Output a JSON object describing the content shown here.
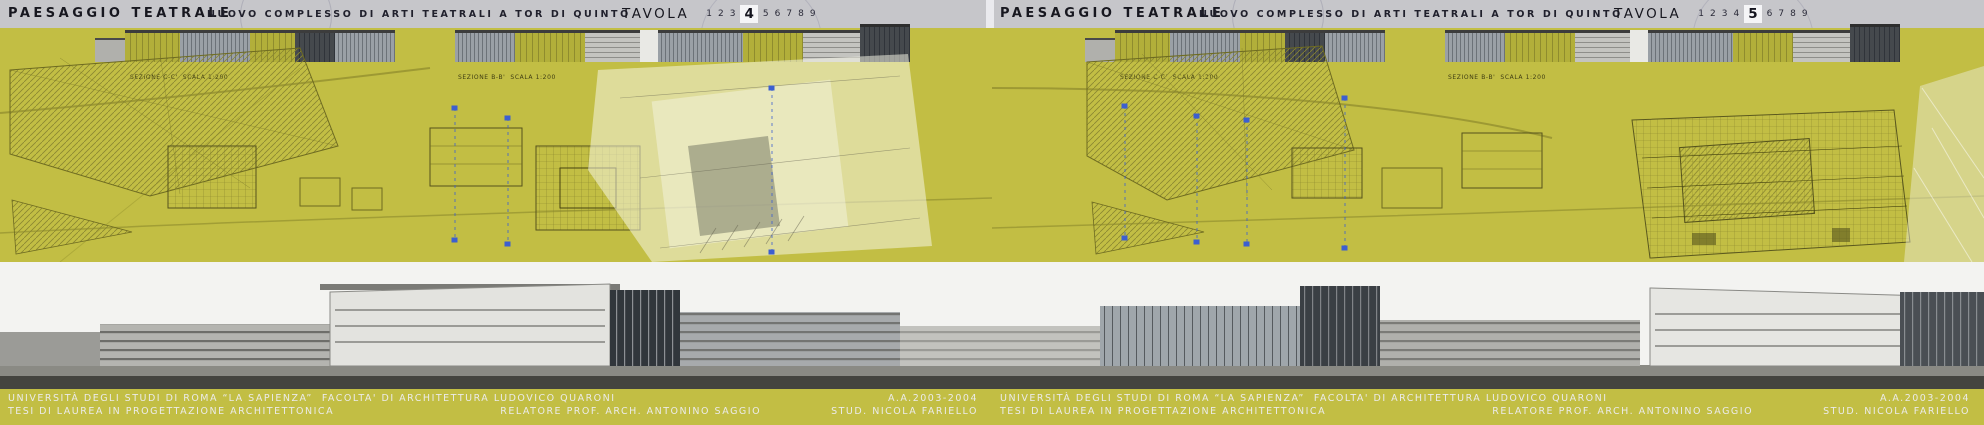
{
  "colors": {
    "olive_background": "#c2be44",
    "header_silver": "#c6c6ca",
    "header_text": "#17171f",
    "plan_linework": "#6e6b21",
    "section_marker_blue": "#3c5fd0",
    "footer_black": "#060606",
    "footer_text": "#ebebe9"
  },
  "panels": [
    {
      "header": {
        "title": "PAESAGGIO TEATRALE",
        "subtitle": "NUOVO COMPLESSO DI ARTI TEATRALI A TOR DI QUINTO",
        "tavola_label": "TAVOLA",
        "numbers": [
          "1",
          "2",
          "3",
          "4",
          "5",
          "6",
          "7",
          "8",
          "9"
        ],
        "active_number": "4"
      },
      "drawings": {
        "section_caption_1": "SEZIONE C-C'  SCALA 1:200",
        "section_caption_2": "SEZIONE B-B'  SCALA 1:200"
      },
      "footer": {
        "university_line": "UNIVERSITÀ DEGLI STUDI DI ROMA “LA SAPIENZA”  FACOLTA' DI ARCHITETTURA LUDOVICO QUARONI",
        "year": "A.A.2003-2004",
        "thesis_line": "TESI DI LAUREA IN PROGETTAZIONE ARCHITETTONICA",
        "advisor": "RELATORE PROF. ARCH. ANTONINO SAGGIO",
        "student": "STUD. NICOLA FARIELLO"
      }
    },
    {
      "header": {
        "title": "PAESAGGIO TEATRALE",
        "subtitle": "NUOVO COMPLESSO DI ARTI TEATRALI A TOR DI QUINTO",
        "tavola_label": "TAVOLA",
        "numbers": [
          "1",
          "2",
          "3",
          "4",
          "5",
          "6",
          "7",
          "8",
          "9"
        ],
        "active_number": "5"
      },
      "drawings": {
        "section_caption_1": "SEZIONE C-C'  SCALA 1:200",
        "section_caption_2": "SEZIONE B-B'  SCALA 1:200"
      },
      "footer": {
        "university_line": "UNIVERSITÀ DEGLI STUDI DI ROMA “LA SAPIENZA”  FACOLTA' DI ARCHITETTURA LUDOVICO QUARONI",
        "year": "A.A.2003-2004",
        "thesis_line": "TESI DI LAUREA IN PROGETTAZIONE ARCHITETTONICA",
        "advisor": "RELATORE PROF. ARCH. ANTONINO SAGGIO",
        "student": "STUD. NICOLA FARIELLO"
      }
    }
  ]
}
